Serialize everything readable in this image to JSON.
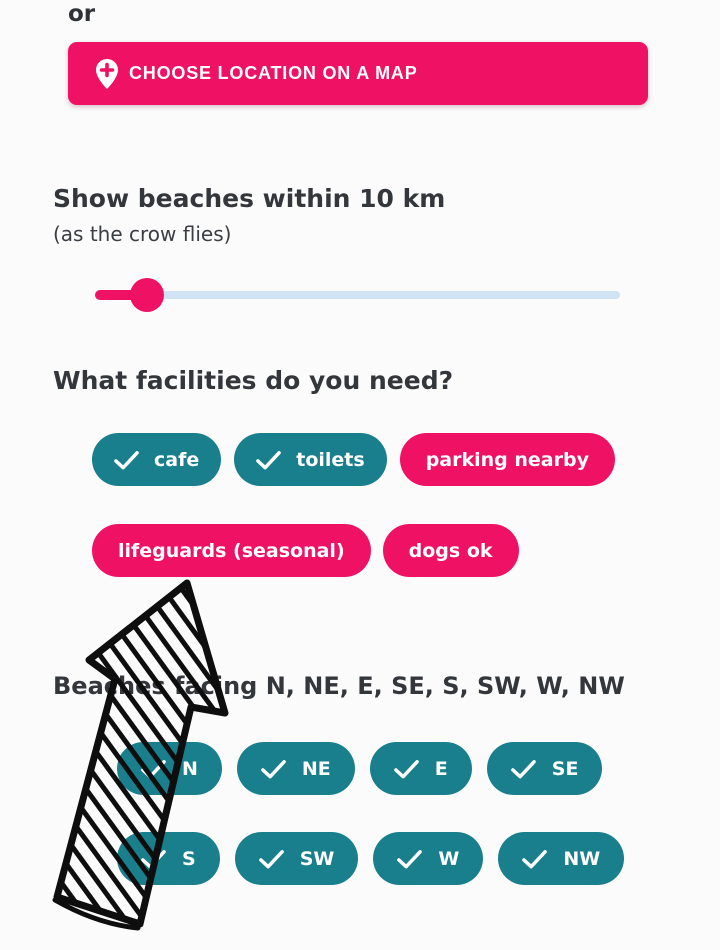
{
  "colors": {
    "pink": "#EE1164",
    "teal": "#1A7F8C",
    "slider_track_blue": "#CFE3F5",
    "heading_text": "#33363B",
    "pill_text": "#FFFFFF",
    "annotation_ink": "#0E0E0E",
    "background": "#FBFBFB"
  },
  "or_label": "or",
  "map_button": {
    "label": "CHOOSE LOCATION ON A MAP",
    "icon": "map-pin-plus-icon"
  },
  "distance": {
    "title": "Show beaches within 10 km",
    "subtitle": "(as the crow flies)",
    "value_km": 10,
    "slider_percent": 10
  },
  "facilities": {
    "title": "What facilities do you need?",
    "options": [
      {
        "label": "cafe",
        "selected": true
      },
      {
        "label": "toilets",
        "selected": true
      },
      {
        "label": "parking nearby",
        "selected": false
      },
      {
        "label": "lifeguards (seasonal)",
        "selected": false
      },
      {
        "label": "dogs ok",
        "selected": false
      }
    ]
  },
  "directions": {
    "title": "Beaches facing N, NE, E, SE, S, SW, W, NW",
    "options": [
      {
        "label": "N",
        "selected": true
      },
      {
        "label": "NE",
        "selected": true
      },
      {
        "label": "E",
        "selected": true
      },
      {
        "label": "SE",
        "selected": true
      },
      {
        "label": "S",
        "selected": true
      },
      {
        "label": "SW",
        "selected": true
      },
      {
        "label": "W",
        "selected": true
      },
      {
        "label": "NW",
        "selected": true
      }
    ]
  },
  "annotation": {
    "type": "hand-drawn arrow pointing up",
    "style": "black outline with diagonal hatching"
  }
}
